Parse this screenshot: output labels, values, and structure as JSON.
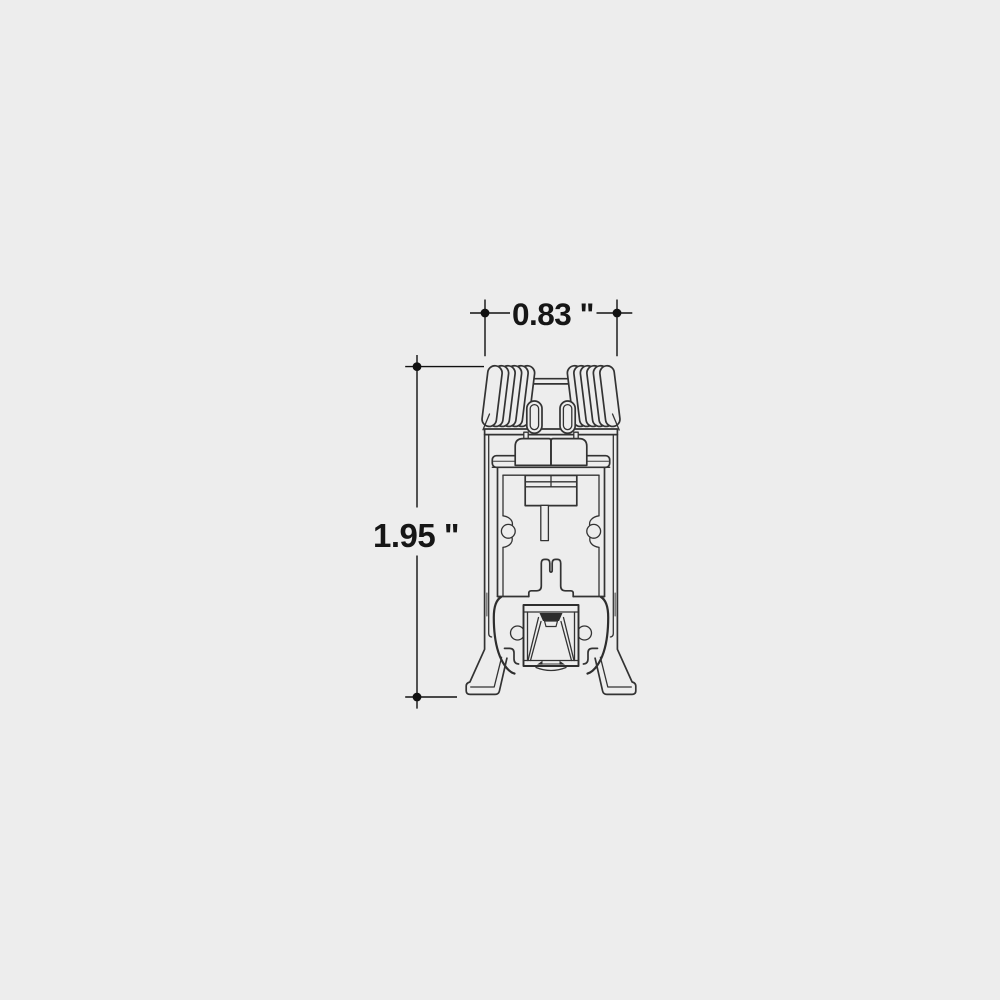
{
  "canvas": {
    "background_color": "#ededed",
    "line_color": "#333333",
    "dimension_color": "#111111"
  },
  "dimensions": {
    "width": {
      "label": "0.83 \"",
      "value": "0.83",
      "unit": "inches",
      "orientation": "horizontal"
    },
    "height": {
      "label": "1.95 \"",
      "value": "1.95",
      "unit": "inches",
      "orientation": "vertical"
    }
  }
}
